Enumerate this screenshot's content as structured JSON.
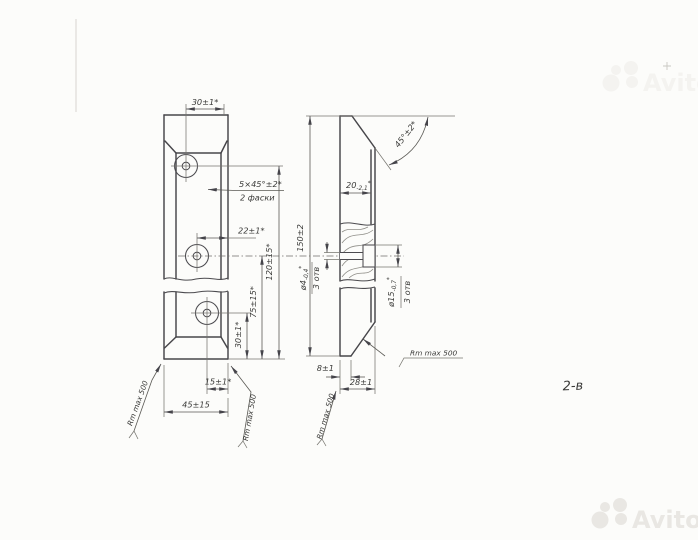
{
  "drawing": {
    "note_2v": "2-в",
    "roughness": "Rm max 500",
    "front_view": {
      "dim_width_top": "30±1*",
      "chamfer_note_line1": "5×45°±2*",
      "chamfer_note_line2": "2 фаски",
      "dim_hole_offset": "22±1*",
      "dim_height_overall": "120±15*",
      "dim_height_mid": "75±15*",
      "dim_height_lower": "30±1*",
      "dim_bottom_width_small": "15±1*",
      "dim_bottom_width": "45±15"
    },
    "side_view": {
      "dim_height": "150±2",
      "dim_top_width_base": "20",
      "dim_top_width_tol": "-2,1",
      "dim_top_width_mark": "*",
      "dim_chamfer_angle": "45°±2*",
      "hole_small_dia_base": "ø4",
      "hole_small_dia_tol": "-0,4",
      "hole_small_dia_mark": "*",
      "hole_small_count": "3 отв",
      "hole_large_dia_base": "ø15",
      "hole_large_dia_tol": "-0,7",
      "hole_large_dia_mark": "*",
      "hole_large_count": "3 отв",
      "dim_bottom_edge": "8±1",
      "dim_bottom_thickness": "28±1"
    }
  },
  "watermark": {
    "brand": "Avito"
  }
}
